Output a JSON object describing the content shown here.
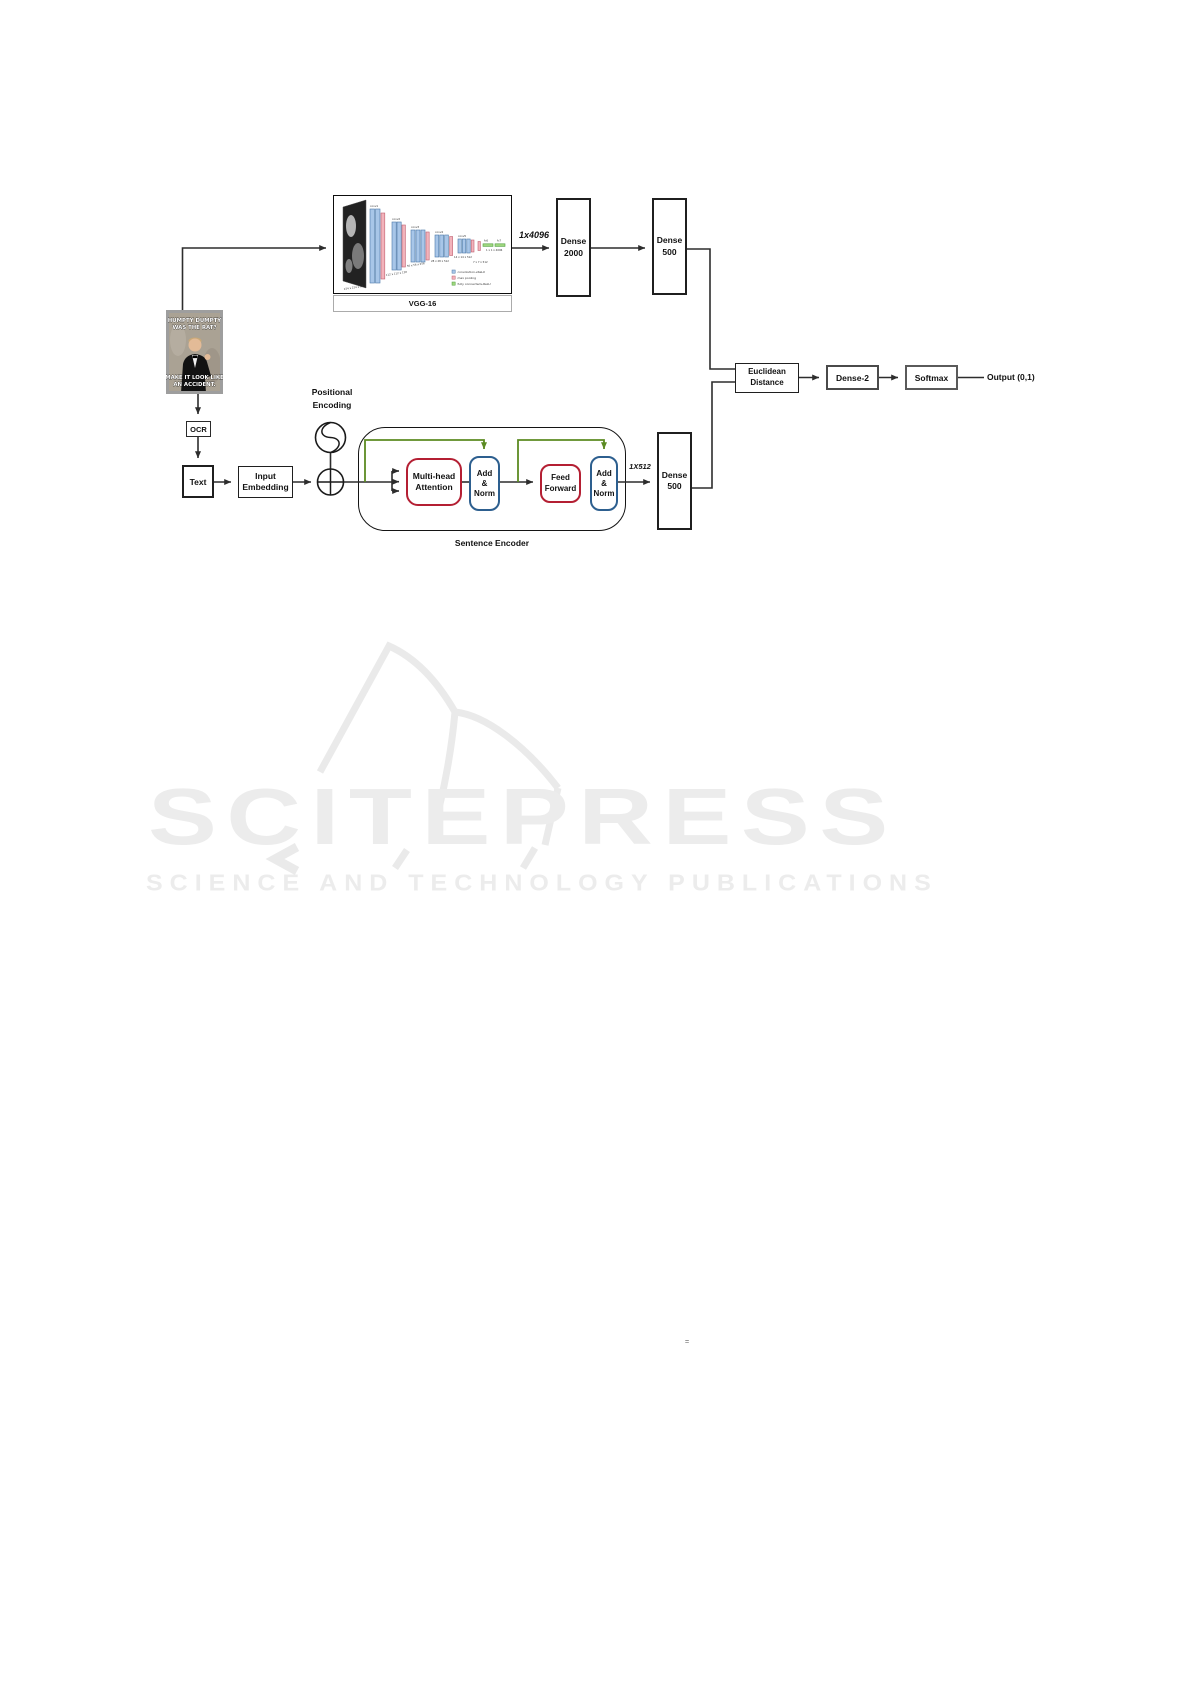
{
  "meme": {
    "top_line1": "HUMPTY DUMPTY",
    "top_line2": "WAS THE RAT?",
    "bottom_line1": "MAKE IT LOOK LIKE",
    "bottom_line2": "AN ACCIDENT."
  },
  "vgg": {
    "caption": "VGG-16",
    "conv_labels": [
      "conv1",
      "conv2",
      "conv3",
      "conv4",
      "conv5"
    ],
    "fc_labels": [
      "fc6",
      "fc7"
    ],
    "dims": [
      "224 x 224 x 64",
      "112 x 112 x 128",
      "56 x 56 x 256",
      "28 x 28 x 512",
      "14 x 14 x 512",
      "7 x 7 x 512",
      "1 x 1 x 4096"
    ],
    "legend": [
      "convolution+ReLU",
      "max pooling",
      "fully connected+ReLU"
    ]
  },
  "image_branch": {
    "feature_label": "1x4096",
    "dense_2000": {
      "line1": "Dense",
      "line2": "2000"
    },
    "dense_500": {
      "line1": "Dense",
      "line2": "500"
    }
  },
  "text_branch": {
    "ocr": "OCR",
    "text": "Text",
    "embedding": {
      "line1": "Input",
      "line2": "Embedding"
    },
    "positional": {
      "line1": "Positional",
      "line2": "Encoding"
    },
    "encoder_caption": "Sentence Encoder",
    "mha": {
      "line1": "Multi-head",
      "line2": "Attention"
    },
    "addnorm1": {
      "line1": "Add",
      "line2": "&",
      "line3": "Norm"
    },
    "ff": {
      "line1": "Feed",
      "line2": "Forward"
    },
    "addnorm2": {
      "line1": "Add",
      "line2": "&",
      "line3": "Norm"
    },
    "feature_label": "1X512",
    "dense_500": {
      "line1": "Dense",
      "line2": "500"
    }
  },
  "fusion": {
    "euclidean": {
      "line1": "Euclidean",
      "line2": "Distance"
    },
    "dense2": "Dense-2",
    "softmax": "Softmax",
    "output": "Output (0,1)"
  },
  "watermark": {
    "logo": "SCITEPRESS",
    "subtitle": "SCIENCE AND TECHNOLOGY PUBLICATIONS"
  },
  "stray_mark": "=",
  "colors": {
    "red_border": "#b41f33",
    "blue_border": "#2d5f8f",
    "green_skip": "#5c8b22",
    "line": "#2d2d2d",
    "watermark": "#ececec"
  }
}
